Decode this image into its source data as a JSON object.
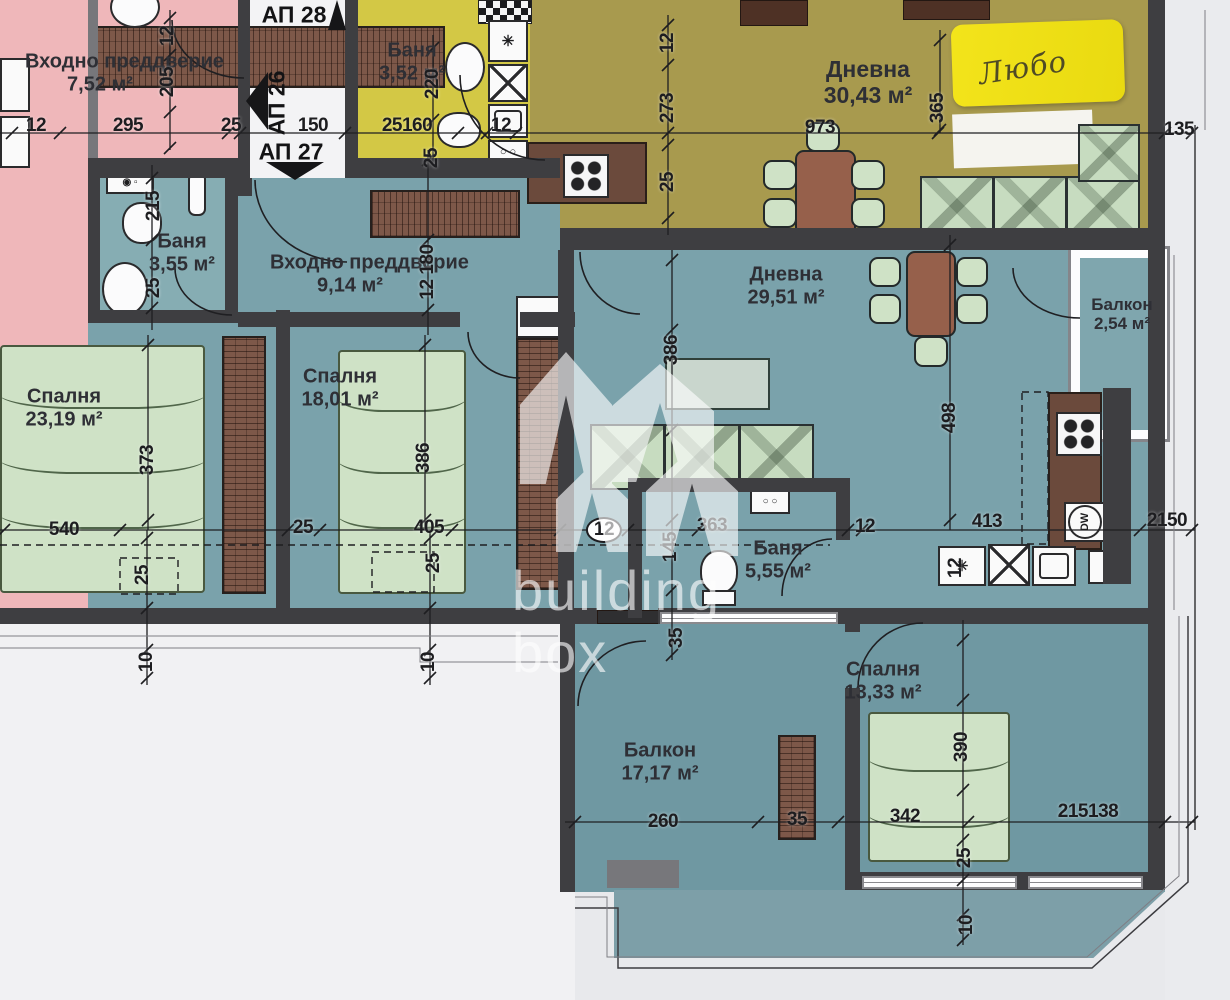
{
  "plan": {
    "rooms": [
      {
        "id": "entry-752",
        "label": "Входно преддверие",
        "area": "7,52 м²",
        "x": 100,
        "y": 73,
        "w": 150
      },
      {
        "id": "bath-352",
        "label": "Баня",
        "area": "3,52 м²",
        "x": 412,
        "y": 62,
        "w": 110
      },
      {
        "id": "living-3043",
        "label": "Дневна",
        "area": "30,43 м²",
        "x": 868,
        "y": 82,
        "w": 220,
        "fs": 23
      },
      {
        "id": "bath-355",
        "label": "Баня",
        "area": "3,55 м²",
        "x": 182,
        "y": 253,
        "w": 120
      },
      {
        "id": "entry-914",
        "label": "Входно преддверие",
        "area": "9,14 м²",
        "x": 350,
        "y": 274,
        "w": 160
      },
      {
        "id": "bedroom-2319",
        "label": "Спалня",
        "area": "23,19 м²",
        "x": 64,
        "y": 408,
        "w": 140
      },
      {
        "id": "bedroom-1801",
        "label": "Спалня",
        "area": "18,01 м²",
        "x": 340,
        "y": 388,
        "w": 140
      },
      {
        "id": "living-2951",
        "label": "Дневна",
        "area": "29,51 м²",
        "x": 786,
        "y": 286,
        "w": 160
      },
      {
        "id": "balcony-254",
        "label": "Балкон",
        "area": "2,54 м²",
        "x": 1122,
        "y": 314,
        "w": 92,
        "fs": 17
      },
      {
        "id": "bath-555",
        "label": "Баня",
        "area": "5,55 м²",
        "x": 778,
        "y": 560,
        "w": 110
      },
      {
        "id": "bedroom-1333",
        "label": "Спалня",
        "area": "13,33 м²",
        "x": 883,
        "y": 681,
        "w": 140
      },
      {
        "id": "balcony-1717",
        "label": "Балкон",
        "area": "17,17 м²",
        "x": 660,
        "y": 762,
        "w": 150
      }
    ],
    "corridor": {
      "items": [
        {
          "t": "АП 28",
          "x": 294,
          "y": 15
        },
        {
          "t": "АП 26",
          "x": 277,
          "y": 103,
          "r": "v"
        },
        {
          "t": "АП 27",
          "x": 291,
          "y": 152
        }
      ]
    },
    "dimensions": [
      {
        "t": "12",
        "x": 36,
        "y": 126
      },
      {
        "t": "295",
        "x": 128,
        "y": 126
      },
      {
        "t": "25",
        "x": 231,
        "y": 126
      },
      {
        "t": "150",
        "x": 313,
        "y": 126
      },
      {
        "t": "25160",
        "x": 407,
        "y": 126
      },
      {
        "t": "12",
        "x": 501,
        "y": 126
      },
      {
        "t": "973",
        "x": 820,
        "y": 128
      },
      {
        "t": "135",
        "x": 1179,
        "y": 130
      },
      {
        "t": "365",
        "x": 938,
        "y": 108,
        "r": "v"
      },
      {
        "t": "12",
        "x": 168,
        "y": 36,
        "r": "v"
      },
      {
        "t": "205",
        "x": 168,
        "y": 82,
        "r": "v"
      },
      {
        "t": "220",
        "x": 433,
        "y": 84,
        "r": "v"
      },
      {
        "t": "25",
        "x": 432,
        "y": 158,
        "r": "v"
      },
      {
        "t": "12",
        "x": 668,
        "y": 43,
        "r": "v"
      },
      {
        "t": "273",
        "x": 668,
        "y": 108,
        "r": "v"
      },
      {
        "t": "25",
        "x": 668,
        "y": 182,
        "r": "v"
      },
      {
        "t": "215",
        "x": 154,
        "y": 206,
        "r": "v"
      },
      {
        "t": "25",
        "x": 154,
        "y": 288,
        "r": "v"
      },
      {
        "t": "12 180",
        "x": 428,
        "y": 272,
        "r": "v"
      },
      {
        "t": "373",
        "x": 148,
        "y": 460,
        "r": "v"
      },
      {
        "t": "386",
        "x": 424,
        "y": 458,
        "r": "v"
      },
      {
        "t": "386",
        "x": 672,
        "y": 350,
        "r": "v"
      },
      {
        "t": "498",
        "x": 950,
        "y": 418,
        "r": "v"
      },
      {
        "t": "540",
        "x": 64,
        "y": 530
      },
      {
        "t": "25",
        "x": 303,
        "y": 528
      },
      {
        "t": "405",
        "x": 429,
        "y": 528
      },
      {
        "t": "12",
        "x": 604,
        "y": 530,
        "o": true
      },
      {
        "t": "145",
        "x": 671,
        "y": 547,
        "r": "v"
      },
      {
        "t": "363",
        "x": 712,
        "y": 526
      },
      {
        "t": "12",
        "x": 865,
        "y": 527
      },
      {
        "t": "413",
        "x": 987,
        "y": 522
      },
      {
        "t": "2150",
        "x": 1167,
        "y": 521
      },
      {
        "t": "35",
        "x": 677,
        "y": 638,
        "r": "v"
      },
      {
        "t": "12",
        "x": 956,
        "y": 568,
        "r": "v"
      },
      {
        "t": "25",
        "x": 143,
        "y": 575,
        "r": "v"
      },
      {
        "t": "10",
        "x": 147,
        "y": 662,
        "r": "v"
      },
      {
        "t": "25",
        "x": 434,
        "y": 563,
        "r": "v"
      },
      {
        "t": "10",
        "x": 429,
        "y": 662,
        "r": "v"
      },
      {
        "t": "260",
        "x": 663,
        "y": 822
      },
      {
        "t": "35",
        "x": 797,
        "y": 820
      },
      {
        "t": "342",
        "x": 905,
        "y": 817
      },
      {
        "t": "215138",
        "x": 1088,
        "y": 812
      },
      {
        "t": "390",
        "x": 962,
        "y": 747,
        "r": "v"
      },
      {
        "t": "25",
        "x": 965,
        "y": 858,
        "r": "v"
      },
      {
        "t": "10",
        "x": 967,
        "y": 925,
        "r": "v"
      }
    ],
    "kitchen": {
      "dw": "DW"
    },
    "icons": {
      "asterisk": "✳",
      "snowflake": "❆"
    },
    "watermark": {
      "line1": "building",
      "line2": "box"
    },
    "sticky_note": "Любо",
    "colors": {
      "pink": "#efb7ba",
      "yellow": "#d3c845",
      "olive": "#a89a4e",
      "teal": "#7aa2ab",
      "teal_dark": "#6f98a2",
      "wall": "#3e3e41",
      "wood": "#7d5849",
      "furniture_green": "#cde0c3",
      "note_yellow": "#f0e31a"
    }
  }
}
